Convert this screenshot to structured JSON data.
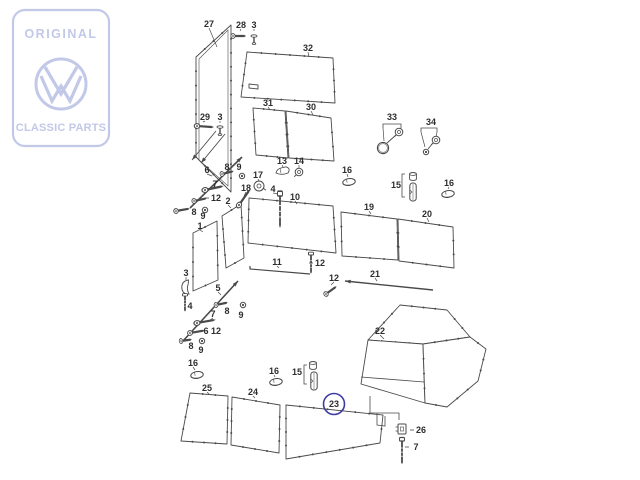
{
  "logo": {
    "top": "ORIGINAL",
    "bottom": "CLASSIC PARTS",
    "color": "#c2c8e8"
  },
  "diagram": {
    "line_color": "#4a4a4a",
    "label_color": "#2d2d2d",
    "highlight_color": "#3c3ca0",
    "highlighted_part": "23",
    "callouts": [
      {
        "part": "27",
        "x": 209,
        "y": 24,
        "leader": [
          217,
          47
        ]
      },
      {
        "part": "28",
        "x": 241,
        "y": 25,
        "leader": [
          240,
          31
        ]
      },
      {
        "part": "3",
        "x": 254,
        "y": 25,
        "leader": [
          254,
          31
        ]
      },
      {
        "part": "32",
        "x": 308,
        "y": 48,
        "leader": [
          309,
          57
        ]
      },
      {
        "part": "31",
        "x": 268,
        "y": 103,
        "leader": [
          270,
          110
        ]
      },
      {
        "part": "30",
        "x": 311,
        "y": 107,
        "leader": [
          313,
          115
        ]
      },
      {
        "part": "33",
        "x": 392,
        "y": 117
      },
      {
        "part": "34",
        "x": 431,
        "y": 122
      },
      {
        "part": "29",
        "x": 205,
        "y": 117,
        "leader": [
          203,
          122
        ]
      },
      {
        "part": "3",
        "x": 220,
        "y": 117,
        "leader": [
          220,
          123
        ]
      },
      {
        "part": "13",
        "x": 282,
        "y": 161,
        "leader": [
          283,
          167
        ]
      },
      {
        "part": "14",
        "x": 299,
        "y": 161,
        "leader": [
          299,
          168
        ]
      },
      {
        "part": "16",
        "x": 347,
        "y": 170,
        "leader": [
          348,
          177
        ]
      },
      {
        "part": "15",
        "x": 396,
        "y": 185
      },
      {
        "part": "16",
        "x": 449,
        "y": 183,
        "leader": [
          448,
          189
        ]
      },
      {
        "part": "17",
        "x": 258,
        "y": 175,
        "leader": [
          259,
          181
        ]
      },
      {
        "part": "18",
        "x": 246,
        "y": 188,
        "leader": [
          244,
          196
        ]
      },
      {
        "part": "4",
        "x": 273,
        "y": 189,
        "leader": [
          278,
          194
        ]
      },
      {
        "part": "10",
        "x": 295,
        "y": 197,
        "leader": [
          297,
          204
        ]
      },
      {
        "part": "6",
        "x": 207,
        "y": 170,
        "leader": [
          212,
          176
        ]
      },
      {
        "part": "8",
        "x": 227,
        "y": 167
      },
      {
        "part": "9",
        "x": 239,
        "y": 167
      },
      {
        "part": "7",
        "x": 215,
        "y": 184
      },
      {
        "part": "12",
        "x": 216,
        "y": 198,
        "dash": true
      },
      {
        "part": "8",
        "x": 194,
        "y": 212
      },
      {
        "part": "9",
        "x": 203,
        "y": 216
      },
      {
        "part": "1",
        "x": 200,
        "y": 226,
        "leader": [
          203,
          232
        ]
      },
      {
        "part": "2",
        "x": 228,
        "y": 201,
        "leader": [
          231,
          208
        ]
      },
      {
        "part": "19",
        "x": 369,
        "y": 207,
        "leader": [
          371,
          214
        ]
      },
      {
        "part": "20",
        "x": 427,
        "y": 214,
        "leader": [
          429,
          222
        ]
      },
      {
        "part": "11",
        "x": 277,
        "y": 262,
        "leader": [
          279,
          268
        ]
      },
      {
        "part": "12",
        "x": 320,
        "y": 263,
        "dash": true
      },
      {
        "part": "12",
        "x": 334,
        "y": 278,
        "leader": [
          331,
          285
        ]
      },
      {
        "part": "21",
        "x": 375,
        "y": 274,
        "leader": [
          377,
          281
        ]
      },
      {
        "part": "3",
        "x": 186,
        "y": 273,
        "leader": [
          186,
          280
        ]
      },
      {
        "part": "4",
        "x": 190,
        "y": 306
      },
      {
        "part": "5",
        "x": 218,
        "y": 288,
        "leader": [
          221,
          295
        ]
      },
      {
        "part": "8",
        "x": 227,
        "y": 311
      },
      {
        "part": "9",
        "x": 241,
        "y": 315
      },
      {
        "part": "7",
        "x": 213,
        "y": 314,
        "leader": [
          210,
          320
        ]
      },
      {
        "part": "6",
        "x": 206,
        "y": 331
      },
      {
        "part": "12",
        "x": 216,
        "y": 331
      },
      {
        "part": "8",
        "x": 191,
        "y": 346
      },
      {
        "part": "9",
        "x": 201,
        "y": 350
      },
      {
        "part": "16",
        "x": 193,
        "y": 363,
        "leader": [
          195,
          370
        ]
      },
      {
        "part": "16",
        "x": 274,
        "y": 371,
        "leader": [
          275,
          377
        ]
      },
      {
        "part": "15",
        "x": 297,
        "y": 372
      },
      {
        "part": "25",
        "x": 207,
        "y": 388,
        "leader": [
          209,
          394
        ]
      },
      {
        "part": "24",
        "x": 253,
        "y": 392,
        "leader": [
          255,
          398
        ]
      },
      {
        "part": "23",
        "x": 334,
        "y": 404,
        "circled": true
      },
      {
        "part": "22",
        "x": 380,
        "y": 331,
        "leader": [
          384,
          339
        ]
      },
      {
        "part": "26",
        "x": 421,
        "y": 430,
        "dash": true
      },
      {
        "part": "7",
        "x": 416,
        "y": 447,
        "dash": true
      }
    ],
    "fasteners": [
      {
        "type": "screw",
        "x": 233,
        "y": 36,
        "len": 13
      },
      {
        "type": "pin",
        "x": 254,
        "y": 36
      },
      {
        "type": "screw",
        "x": 197,
        "y": 126,
        "r": 4,
        "len": 17
      },
      {
        "type": "pin",
        "x": 220,
        "y": 127
      },
      {
        "type": "screw",
        "x": 222,
        "y": 174,
        "r": -14,
        "len": 12
      },
      {
        "type": "nut",
        "x": 242,
        "y": 176
      },
      {
        "type": "screw",
        "x": 205,
        "y": 190,
        "r": -12,
        "len": 19
      },
      {
        "type": "screw",
        "x": 194,
        "y": 201,
        "r": -12,
        "len": 13
      },
      {
        "type": "screw",
        "x": 176,
        "y": 211,
        "r": -10,
        "len": 14
      },
      {
        "type": "nut",
        "x": 205,
        "y": 210
      },
      {
        "type": "flagclip",
        "x": 283,
        "y": 171
      },
      {
        "type": "grommet2",
        "x": 299,
        "y": 172
      },
      {
        "type": "grommet",
        "x": 259,
        "y": 186
      },
      {
        "type": "screw",
        "x": 239,
        "y": 205,
        "r": -55,
        "len": 19
      },
      {
        "type": "screwv",
        "x": 280,
        "y": 196,
        "len": 29
      },
      {
        "type": "clip",
        "x": 349,
        "y": 182,
        "r": -8
      },
      {
        "type": "capnut",
        "x": 413,
        "y": 177
      },
      {
        "type": "longclip",
        "x": 413,
        "y": 192
      },
      {
        "type": "clip",
        "x": 448,
        "y": 194,
        "r": -8
      },
      {
        "type": "ring",
        "x": 383,
        "y": 148
      },
      {
        "type": "grommet2",
        "x": 399,
        "y": 132
      },
      {
        "type": "grommet2",
        "x": 436,
        "y": 140
      },
      {
        "type": "nut",
        "x": 426,
        "y": 152
      },
      {
        "type": "hook",
        "x": 186,
        "y": 288
      },
      {
        "type": "screwv",
        "x": 185,
        "y": 296,
        "len": 14
      },
      {
        "type": "screw",
        "x": 216,
        "y": 305,
        "r": -12,
        "len": 12
      },
      {
        "type": "nut",
        "x": 243,
        "y": 305
      },
      {
        "type": "screw",
        "x": 197,
        "y": 323,
        "r": -10,
        "len": 19
      },
      {
        "type": "screw",
        "x": 190,
        "y": 333,
        "r": -10,
        "len": 15
      },
      {
        "type": "screw",
        "x": 181,
        "y": 341,
        "r": -8,
        "len": 11
      },
      {
        "type": "nut",
        "x": 202,
        "y": 341
      },
      {
        "type": "clip",
        "x": 197,
        "y": 375,
        "r": -8
      },
      {
        "type": "clip",
        "x": 276,
        "y": 382,
        "r": -8
      },
      {
        "type": "capnut",
        "x": 313,
        "y": 366
      },
      {
        "type": "longclip",
        "x": 314,
        "y": 381
      },
      {
        "type": "screwv",
        "x": 311,
        "y": 255,
        "len": 17
      },
      {
        "type": "screw",
        "x": 326,
        "y": 294,
        "r": -36,
        "len": 13
      },
      {
        "type": "squarenut",
        "x": 402,
        "y": 429
      },
      {
        "type": "screwv",
        "x": 402,
        "y": 441,
        "len": 21
      }
    ]
  }
}
